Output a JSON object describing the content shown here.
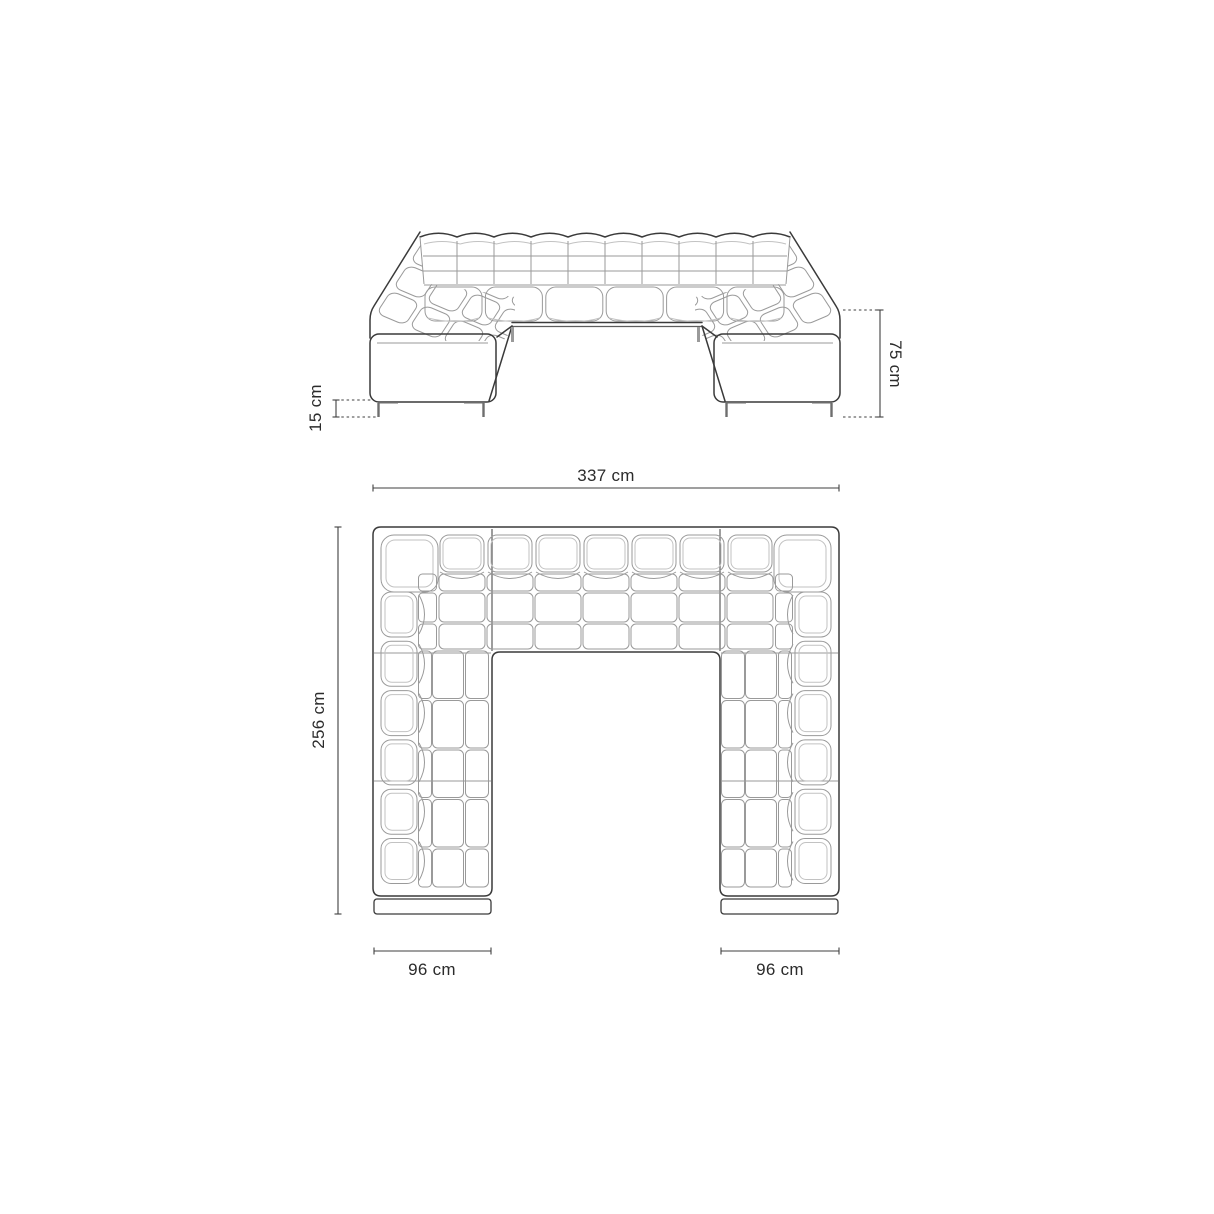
{
  "colors": {
    "background": "#ffffff",
    "outline": "#3a3a3a",
    "tufting_lines": "#9a9a9a",
    "dimension_lines": "#3f3f3f",
    "label_text": "#2b2b2b"
  },
  "views": {
    "front_elevation": {
      "dimensions": {
        "leg_height": "15 cm",
        "total_height": "75 cm"
      }
    },
    "top_plan": {
      "dimensions": {
        "total_width": "337 cm",
        "total_depth": "256 cm",
        "left_arm_width": "96 cm",
        "right_arm_width": "96 cm"
      }
    }
  }
}
